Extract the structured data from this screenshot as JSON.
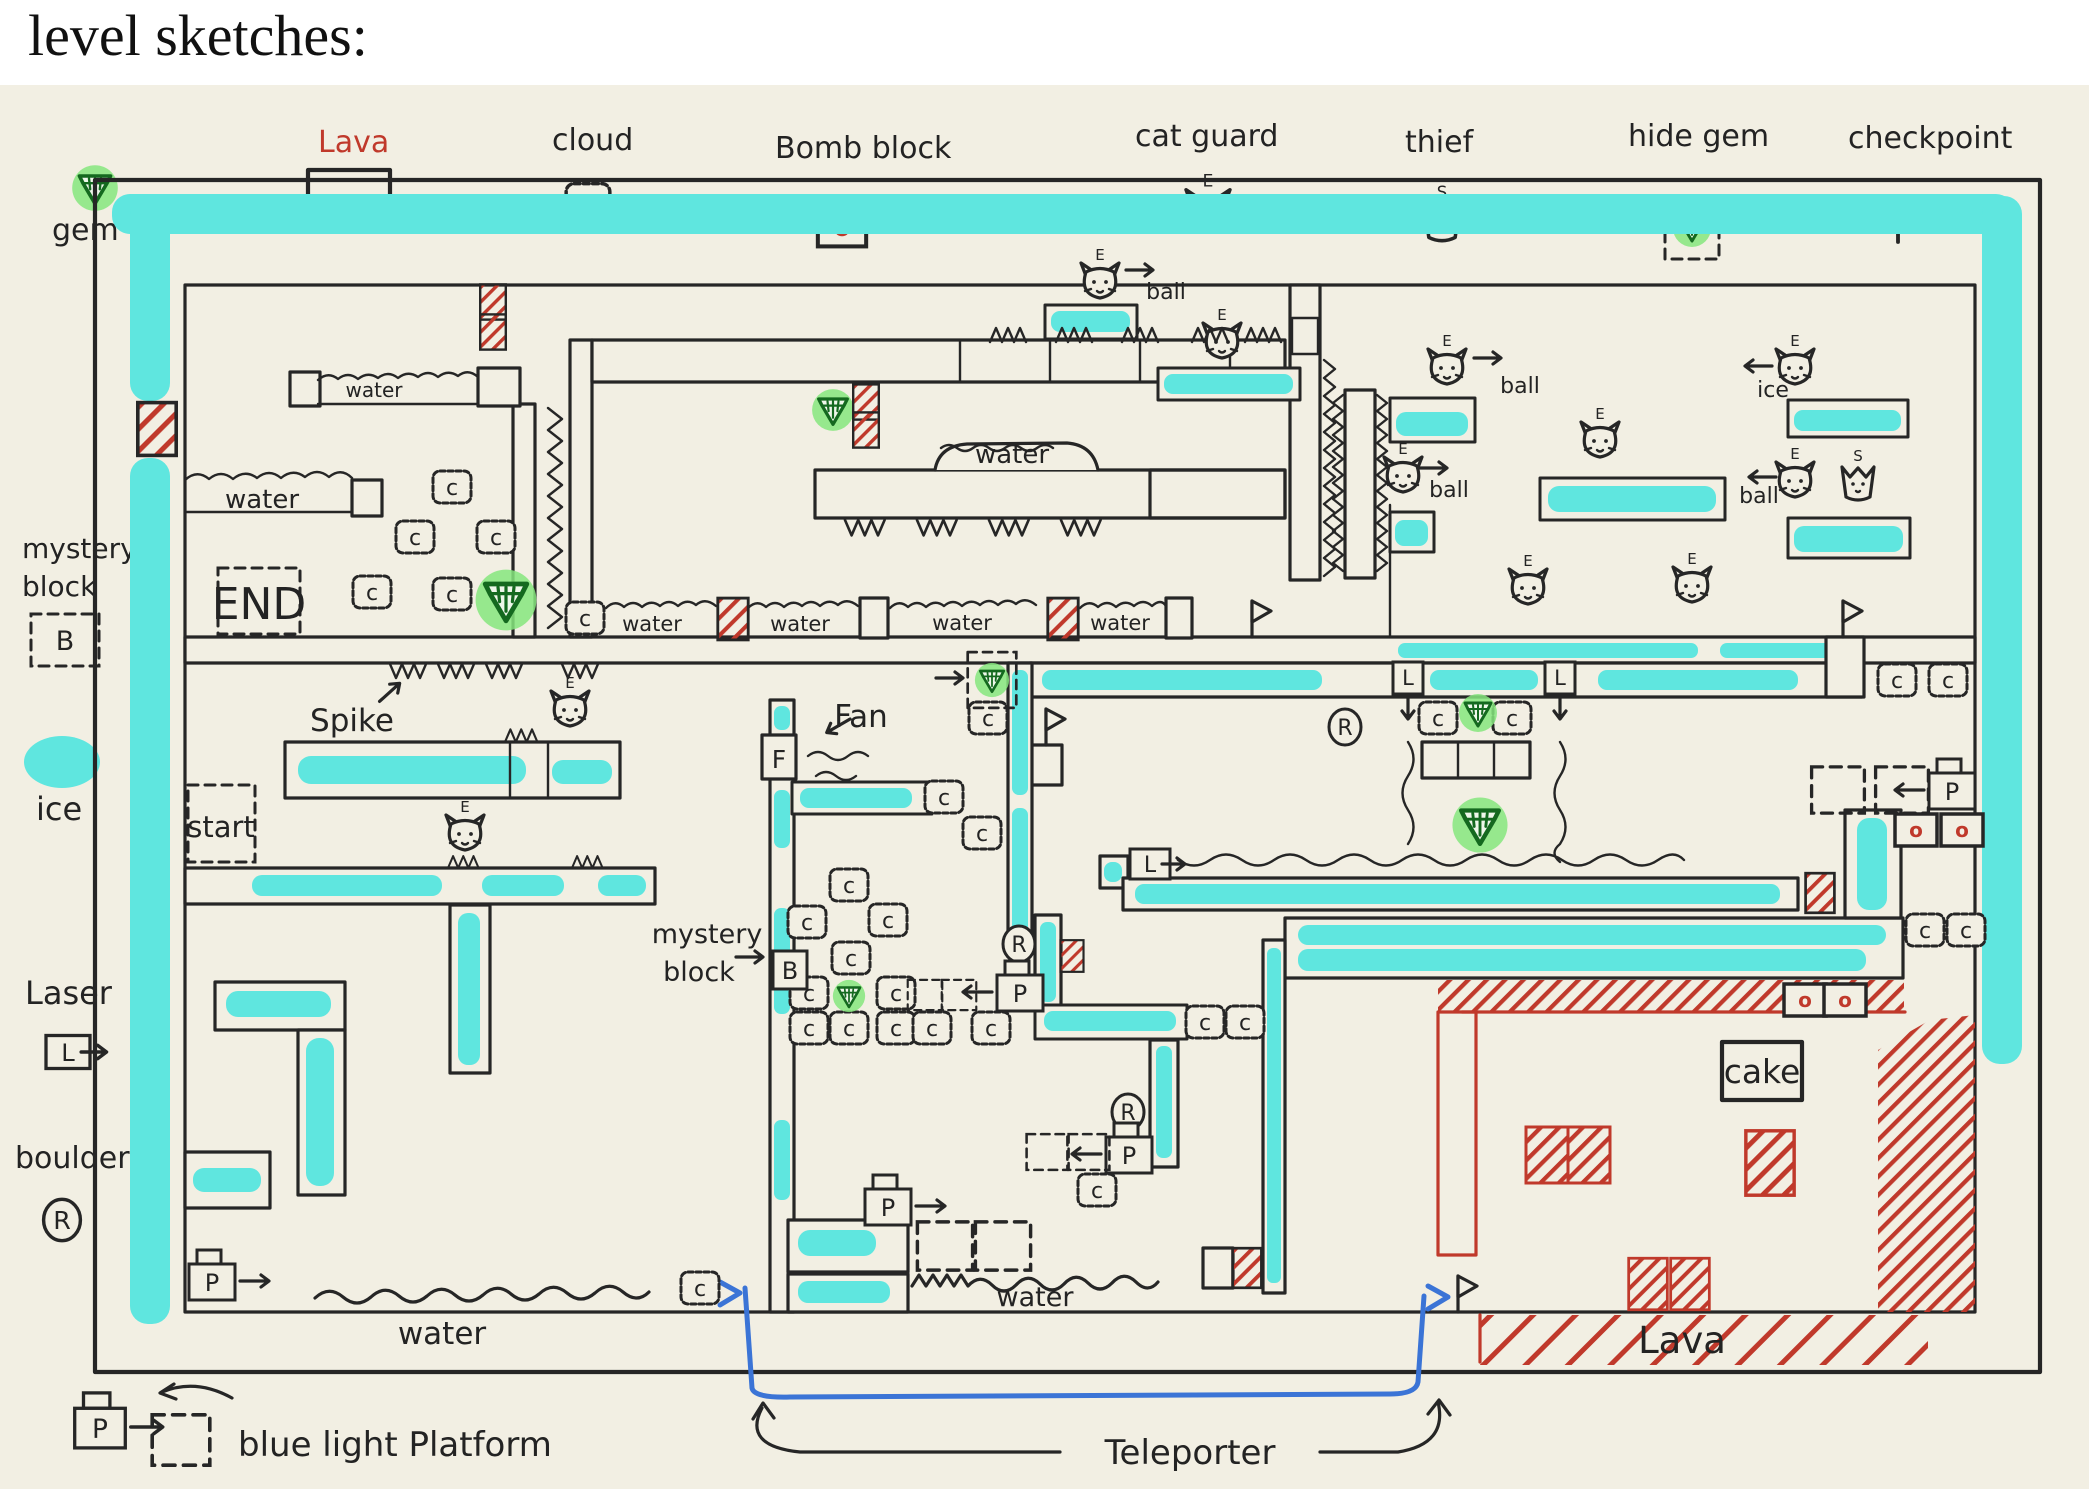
{
  "title": "level sketches:",
  "colors": {
    "paper": "#f2efe3",
    "ink": "#262626",
    "ice_cyan": "#5fe6df",
    "gem_green_glow": "#86e67e",
    "gem_green_dark": "#14691f",
    "lava_red": "#c0392b",
    "teleporter_blue": "#3b74d6"
  },
  "symbols": {
    "cloud": "c",
    "bomb": "o",
    "cat_guard": "E",
    "thief": "S",
    "mystery_block": "B",
    "laser": "L",
    "boulder": "R",
    "platform": "P",
    "fan": "F"
  },
  "legend_top": [
    {
      "label": "gem"
    },
    {
      "label": "Lava"
    },
    {
      "label": "cloud"
    },
    {
      "label": "Bomb block"
    },
    {
      "label": "cat guard"
    },
    {
      "label": "thief"
    },
    {
      "label": "hide gem"
    },
    {
      "label": "checkpoint"
    }
  ],
  "legend_left": [
    {
      "label": "mystery",
      "label2": "block"
    },
    {
      "label": "ice"
    },
    {
      "label": "Laser"
    },
    {
      "label": "boulder"
    }
  ],
  "legend_bottom": {
    "platform_label": "blue light Platform",
    "teleporter_label": "Teleporter"
  },
  "map": {
    "texts": [
      {
        "text": "water",
        "x": 374,
        "y": 397,
        "s": 20
      },
      {
        "text": "water",
        "x": 262,
        "y": 508,
        "s": 26
      },
      {
        "text": "water",
        "x": 1012,
        "y": 463,
        "s": 26
      },
      {
        "text": "water",
        "x": 652,
        "y": 631,
        "s": 21
      },
      {
        "text": "water",
        "x": 800,
        "y": 631,
        "s": 21
      },
      {
        "text": "water",
        "x": 962,
        "y": 630,
        "s": 21
      },
      {
        "text": "water",
        "x": 1120,
        "y": 630,
        "s": 21
      },
      {
        "text": "water",
        "x": 442,
        "y": 1344,
        "s": 31
      },
      {
        "text": "water",
        "x": 1035,
        "y": 1306,
        "s": 27
      },
      {
        "text": "END",
        "x": 259,
        "y": 619,
        "s": 44
      },
      {
        "text": "start",
        "x": 221,
        "y": 837,
        "s": 29
      },
      {
        "text": "Spike",
        "x": 352,
        "y": 731,
        "s": 31
      },
      {
        "text": "Fan",
        "x": 861,
        "y": 727,
        "s": 31
      },
      {
        "text": "mystery",
        "x": 707,
        "y": 943,
        "s": 27
      },
      {
        "text": "block",
        "x": 699,
        "y": 981,
        "s": 27
      },
      {
        "text": "cake",
        "x": 1762,
        "y": 1083,
        "s": 33
      },
      {
        "text": "Lava",
        "x": 1682,
        "y": 1353,
        "s": 37,
        "c": "#c0392b"
      },
      {
        "text": "ball",
        "x": 1520,
        "y": 393,
        "s": 22
      },
      {
        "text": "ball",
        "x": 1449,
        "y": 497,
        "s": 22
      },
      {
        "text": "ball",
        "x": 1759,
        "y": 503,
        "s": 22
      },
      {
        "text": "ball",
        "x": 1166,
        "y": 299,
        "s": 22
      },
      {
        "text": "ice",
        "x": 1773,
        "y": 397,
        "s": 22
      }
    ],
    "items": [
      {
        "t": "cloud",
        "x": 452,
        "y": 487
      },
      {
        "t": "cloud",
        "x": 415,
        "y": 537
      },
      {
        "t": "cloud",
        "x": 496,
        "y": 537
      },
      {
        "t": "cloud",
        "x": 372,
        "y": 592
      },
      {
        "t": "cloud",
        "x": 452,
        "y": 594
      },
      {
        "t": "cloud",
        "x": 585,
        "y": 618
      },
      {
        "t": "cloud",
        "x": 988,
        "y": 718
      },
      {
        "t": "cloud",
        "x": 944,
        "y": 797
      },
      {
        "t": "cloud",
        "x": 982,
        "y": 833
      },
      {
        "t": "cloud",
        "x": 849,
        "y": 885
      },
      {
        "t": "cloud",
        "x": 807,
        "y": 922
      },
      {
        "t": "cloud",
        "x": 888,
        "y": 920
      },
      {
        "t": "cloud",
        "x": 851,
        "y": 958
      },
      {
        "t": "cloud",
        "x": 809,
        "y": 993
      },
      {
        "t": "cloud",
        "x": 896,
        "y": 993
      },
      {
        "t": "cloud",
        "x": 809,
        "y": 1028
      },
      {
        "t": "cloud",
        "x": 849,
        "y": 1028
      },
      {
        "t": "cloud",
        "x": 896,
        "y": 1028
      },
      {
        "t": "cloud",
        "x": 932,
        "y": 1028
      },
      {
        "t": "cloud",
        "x": 991,
        "y": 1028
      },
      {
        "t": "cloud",
        "x": 1438,
        "y": 718
      },
      {
        "t": "cloud",
        "x": 1512,
        "y": 718
      },
      {
        "t": "cloud",
        "x": 1897,
        "y": 680
      },
      {
        "t": "cloud",
        "x": 1948,
        "y": 680
      },
      {
        "t": "cloud",
        "x": 1925,
        "y": 930
      },
      {
        "t": "cloud",
        "x": 1966,
        "y": 930
      },
      {
        "t": "cloud",
        "x": 1205,
        "y": 1022
      },
      {
        "t": "cloud",
        "x": 1245,
        "y": 1022
      },
      {
        "t": "cloud",
        "x": 1097,
        "y": 1190
      },
      {
        "t": "cloud",
        "x": 700,
        "y": 1288
      },
      {
        "t": "bomb",
        "x": 1916,
        "y": 830
      },
      {
        "t": "bomb",
        "x": 1962,
        "y": 830
      },
      {
        "t": "bomb",
        "x": 1805,
        "y": 1000
      },
      {
        "t": "bomb",
        "x": 1845,
        "y": 1000
      },
      {
        "t": "cat",
        "x": 1100,
        "y": 284
      },
      {
        "t": "cat",
        "x": 1222,
        "y": 344
      },
      {
        "t": "cat",
        "x": 1447,
        "y": 370
      },
      {
        "t": "cat",
        "x": 1403,
        "y": 478
      },
      {
        "t": "cat",
        "x": 1600,
        "y": 443
      },
      {
        "t": "cat",
        "x": 1528,
        "y": 590
      },
      {
        "t": "cat",
        "x": 1692,
        "y": 588
      },
      {
        "t": "cat",
        "x": 1795,
        "y": 370
      },
      {
        "t": "cat",
        "x": 1795,
        "y": 483
      },
      {
        "t": "cat",
        "x": 570,
        "y": 712
      },
      {
        "t": "cat",
        "x": 465,
        "y": 836
      },
      {
        "t": "thief",
        "x": 1858,
        "y": 483
      },
      {
        "t": "gem",
        "x": 506,
        "y": 600,
        "s": 1.6
      },
      {
        "t": "gem",
        "x": 833,
        "y": 410,
        "s": 1.1
      },
      {
        "t": "gem",
        "x": 1478,
        "y": 713
      },
      {
        "t": "gem",
        "x": 1480,
        "y": 825,
        "s": 1.45
      },
      {
        "t": "gem",
        "x": 849,
        "y": 996,
        "s": 0.85
      },
      {
        "t": "hgem",
        "x": 992,
        "y": 680,
        "s": 0.9
      },
      {
        "t": "flag",
        "x": 1252,
        "y": 637
      },
      {
        "t": "flag",
        "x": 1843,
        "y": 637
      },
      {
        "t": "flag",
        "x": 1046,
        "y": 745
      },
      {
        "t": "flag",
        "x": 1458,
        "y": 1312
      },
      {
        "t": "laser-r",
        "x": 1150,
        "y": 864
      },
      {
        "t": "laser-d",
        "x": 1408,
        "y": 678
      },
      {
        "t": "laser-d",
        "x": 1560,
        "y": 678
      },
      {
        "t": "boulder",
        "x": 1345,
        "y": 727
      },
      {
        "t": "boulder",
        "x": 1019,
        "y": 944
      },
      {
        "t": "boulder",
        "x": 1128,
        "y": 1112
      },
      {
        "t": "pplat-l",
        "x": 1020,
        "y": 992
      },
      {
        "t": "pplat-l",
        "x": 1952,
        "y": 790
      },
      {
        "t": "pplat-l",
        "x": 1129,
        "y": 1154
      },
      {
        "t": "pplat-r",
        "x": 888,
        "y": 1206
      },
      {
        "t": "pplat-r",
        "x": 212,
        "y": 1281
      },
      {
        "t": "dash",
        "x": 925,
        "y": 995,
        "s": 0.72
      },
      {
        "t": "dash",
        "x": 959,
        "y": 995,
        "s": 0.72
      },
      {
        "t": "dash",
        "x": 1838,
        "y": 790,
        "s": 1.1
      },
      {
        "t": "dash",
        "x": 1902,
        "y": 790,
        "s": 1.1
      },
      {
        "t": "dash",
        "x": 1047,
        "y": 1152,
        "s": 0.85
      },
      {
        "t": "dash",
        "x": 1089,
        "y": 1152,
        "s": 0.85
      },
      {
        "t": "dash",
        "x": 945,
        "y": 1246,
        "s": 1.15
      },
      {
        "t": "dash",
        "x": 1003,
        "y": 1246,
        "s": 1.15
      },
      {
        "t": "mysteryB",
        "x": 790,
        "y": 970
      },
      {
        "t": "lava",
        "x": 493,
        "y": 302,
        "s": 0.8
      },
      {
        "t": "lava",
        "x": 493,
        "y": 332,
        "s": 0.8
      },
      {
        "t": "lava",
        "x": 866,
        "y": 402,
        "s": 0.8
      },
      {
        "t": "lava",
        "x": 866,
        "y": 430,
        "s": 0.8
      },
      {
        "t": "lava",
        "x": 733,
        "y": 619,
        "s": 0.95
      },
      {
        "t": "lava",
        "x": 1063,
        "y": 619,
        "s": 0.95
      },
      {
        "t": "lava",
        "x": 157,
        "y": 429,
        "s": 1.2
      },
      {
        "t": "lava",
        "x": 1072,
        "y": 956,
        "s": 0.72
      },
      {
        "t": "lava",
        "x": 1247,
        "y": 1268,
        "s": 0.9
      },
      {
        "t": "lava",
        "x": 1820,
        "y": 893,
        "s": 0.9
      },
      {
        "t": "lava-red",
        "x": 1547,
        "y": 1155
      },
      {
        "t": "lava-red",
        "x": 1589,
        "y": 1155
      },
      {
        "t": "lava-red",
        "x": 1770,
        "y": 1163,
        "s": 1.15
      },
      {
        "t": "lava-red",
        "x": 1648,
        "y": 1284,
        "s": 0.92
      },
      {
        "t": "lava-red",
        "x": 1690,
        "y": 1284,
        "s": 0.92
      },
      {
        "t": "arrow-r",
        "x": 1140,
        "y": 270
      },
      {
        "t": "arrow-r",
        "x": 1488,
        "y": 358
      },
      {
        "t": "arrow-r",
        "x": 1434,
        "y": 468
      },
      {
        "t": "arrow-r",
        "x": 950,
        "y": 678
      },
      {
        "t": "arrow-r",
        "x": 750,
        "y": 957
      },
      {
        "t": "arrow-r",
        "x": 390,
        "y": 692,
        "r": -42
      },
      {
        "t": "arrow-l",
        "x": 1758,
        "y": 366
      },
      {
        "t": "arrow-l",
        "x": 1762,
        "y": 477
      },
      {
        "t": "arrow-l",
        "x": 838,
        "y": 726,
        "r": -30
      },
      {
        "t": "spikes-u",
        "x": 990,
        "y": 342
      },
      {
        "t": "spikes-u",
        "x": 1056,
        "y": 342
      },
      {
        "t": "spikes-u",
        "x": 1122,
        "y": 342
      },
      {
        "t": "spikes-u",
        "x": 1192,
        "y": 342
      },
      {
        "t": "spikes-u",
        "x": 1245,
        "y": 342
      },
      {
        "t": "spikes-u",
        "x": 505,
        "y": 742,
        "s": 0.9
      },
      {
        "t": "spikes-u",
        "x": 448,
        "y": 868,
        "s": 0.85
      },
      {
        "t": "spikes-u",
        "x": 572,
        "y": 868,
        "s": 0.85
      },
      {
        "t": "spikes-d",
        "x": 845,
        "y": 520,
        "s": 1.1
      },
      {
        "t": "spikes-d",
        "x": 917,
        "y": 520,
        "s": 1.1
      },
      {
        "t": "spikes-d",
        "x": 989,
        "y": 520,
        "s": 1.1
      },
      {
        "t": "spikes-d",
        "x": 1061,
        "y": 520,
        "s": 1.1
      },
      {
        "t": "spikes-d",
        "x": 390,
        "y": 664
      },
      {
        "t": "spikes-d",
        "x": 438,
        "y": 664
      },
      {
        "t": "spikes-d",
        "x": 486,
        "y": 664
      },
      {
        "t": "spikes-d",
        "x": 562,
        "y": 664
      }
    ]
  }
}
